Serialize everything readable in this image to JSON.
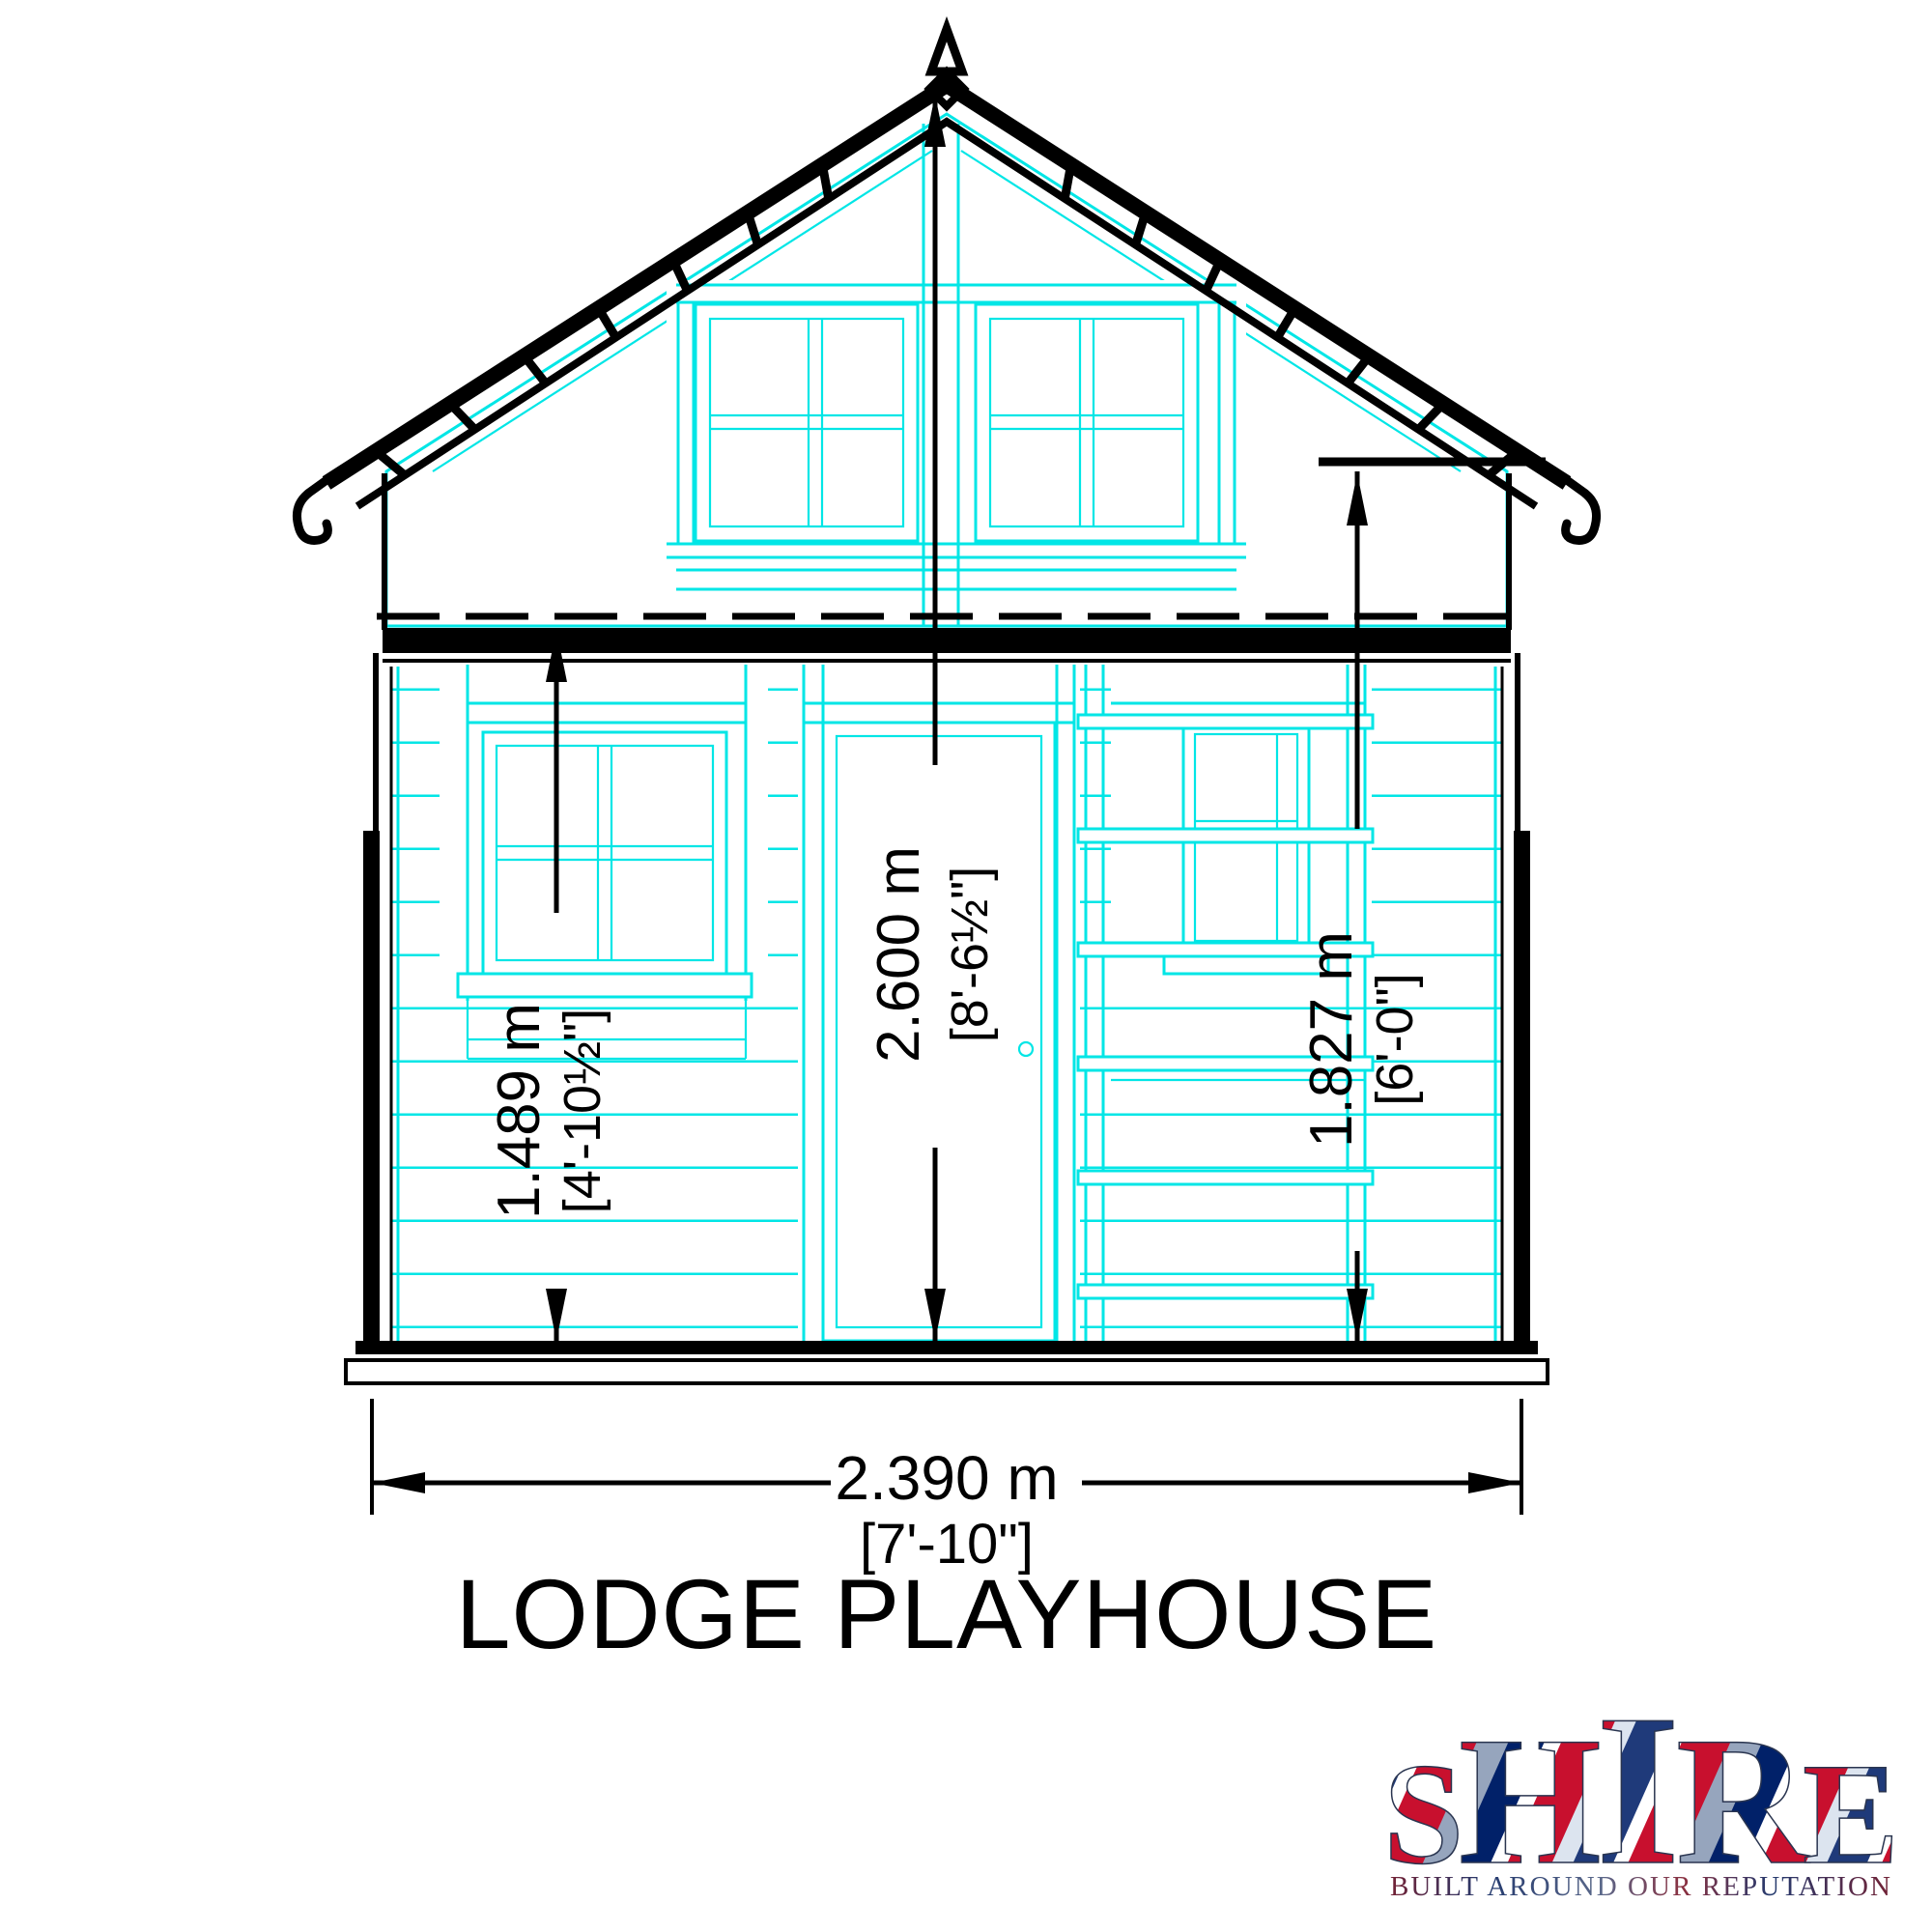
{
  "title": "LODGE PLAYHOUSE",
  "dimensions": {
    "height_left": {
      "metric": "1.489 m",
      "imperial": "[4'-10½\"]"
    },
    "height_center": {
      "metric": "2.600 m",
      "imperial": "[8'-6½\"]"
    },
    "height_right": {
      "metric": "1.827 m",
      "imperial": "[6'-0\"]"
    },
    "width_overall": {
      "metric": "2.390 m",
      "imperial": "[7'-10\"]"
    }
  },
  "logo": {
    "letters": [
      "S",
      "H",
      "I",
      "R",
      "E"
    ],
    "tagline": "BUILT AROUND OUR REPUTATION"
  },
  "colors": {
    "outline": "#000000",
    "detail_cyan": "#00e6e6",
    "logo_red": "#c8102e",
    "logo_blue": "#012169",
    "background": "#ffffff"
  }
}
